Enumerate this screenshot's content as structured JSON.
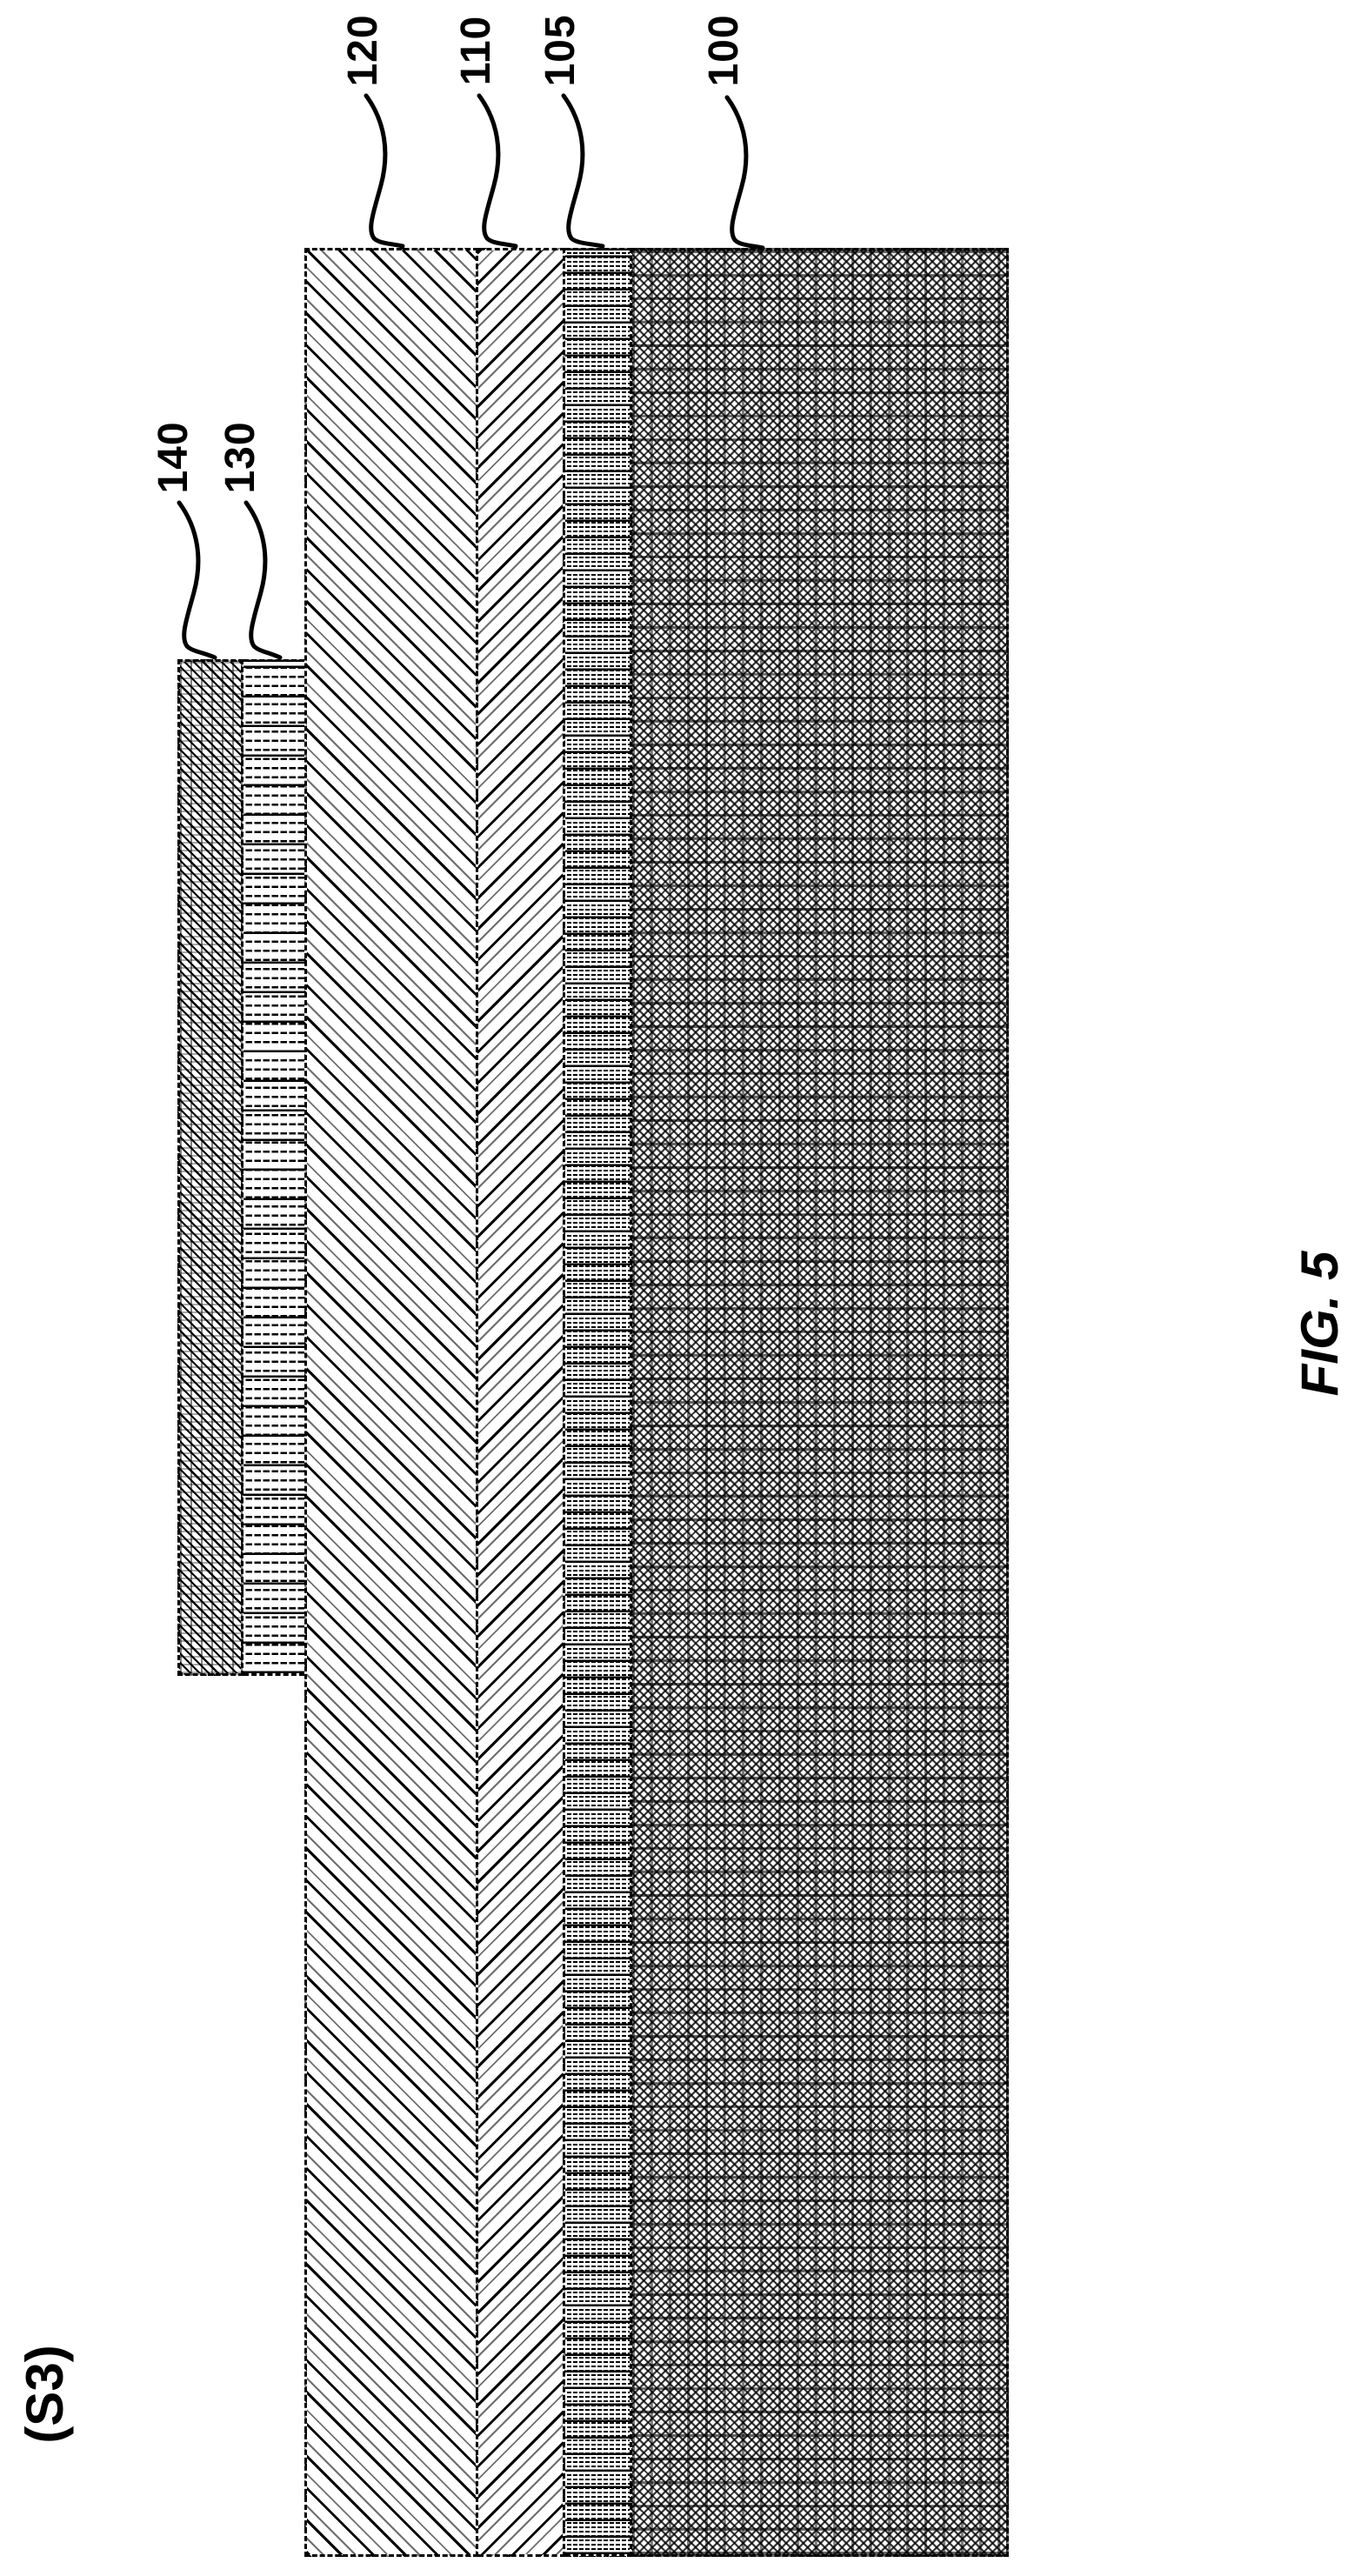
{
  "figure": {
    "step_label": "(S3)",
    "caption": "FIG. 5"
  },
  "reference_numerals": {
    "r120": "120",
    "r110": "110",
    "r105": "105",
    "r100": "100",
    "r140": "140",
    "r130": "130"
  },
  "layers": [
    {
      "ref": "120",
      "pattern": "diagonal-hatch-backslash"
    },
    {
      "ref": "110",
      "pattern": "diagonal-hatch-slash"
    },
    {
      "ref": "105",
      "pattern": "horizontal-dash-rows-fine"
    },
    {
      "ref": "100",
      "pattern": "dense-crosshatch-halftone"
    },
    {
      "ref": "140",
      "pattern": "fine-weave-crosshatch"
    },
    {
      "ref": "130",
      "pattern": "horizontal-dash-rows-coarse"
    }
  ],
  "colors": {
    "ink": "#000000",
    "paper": "#ffffff"
  }
}
